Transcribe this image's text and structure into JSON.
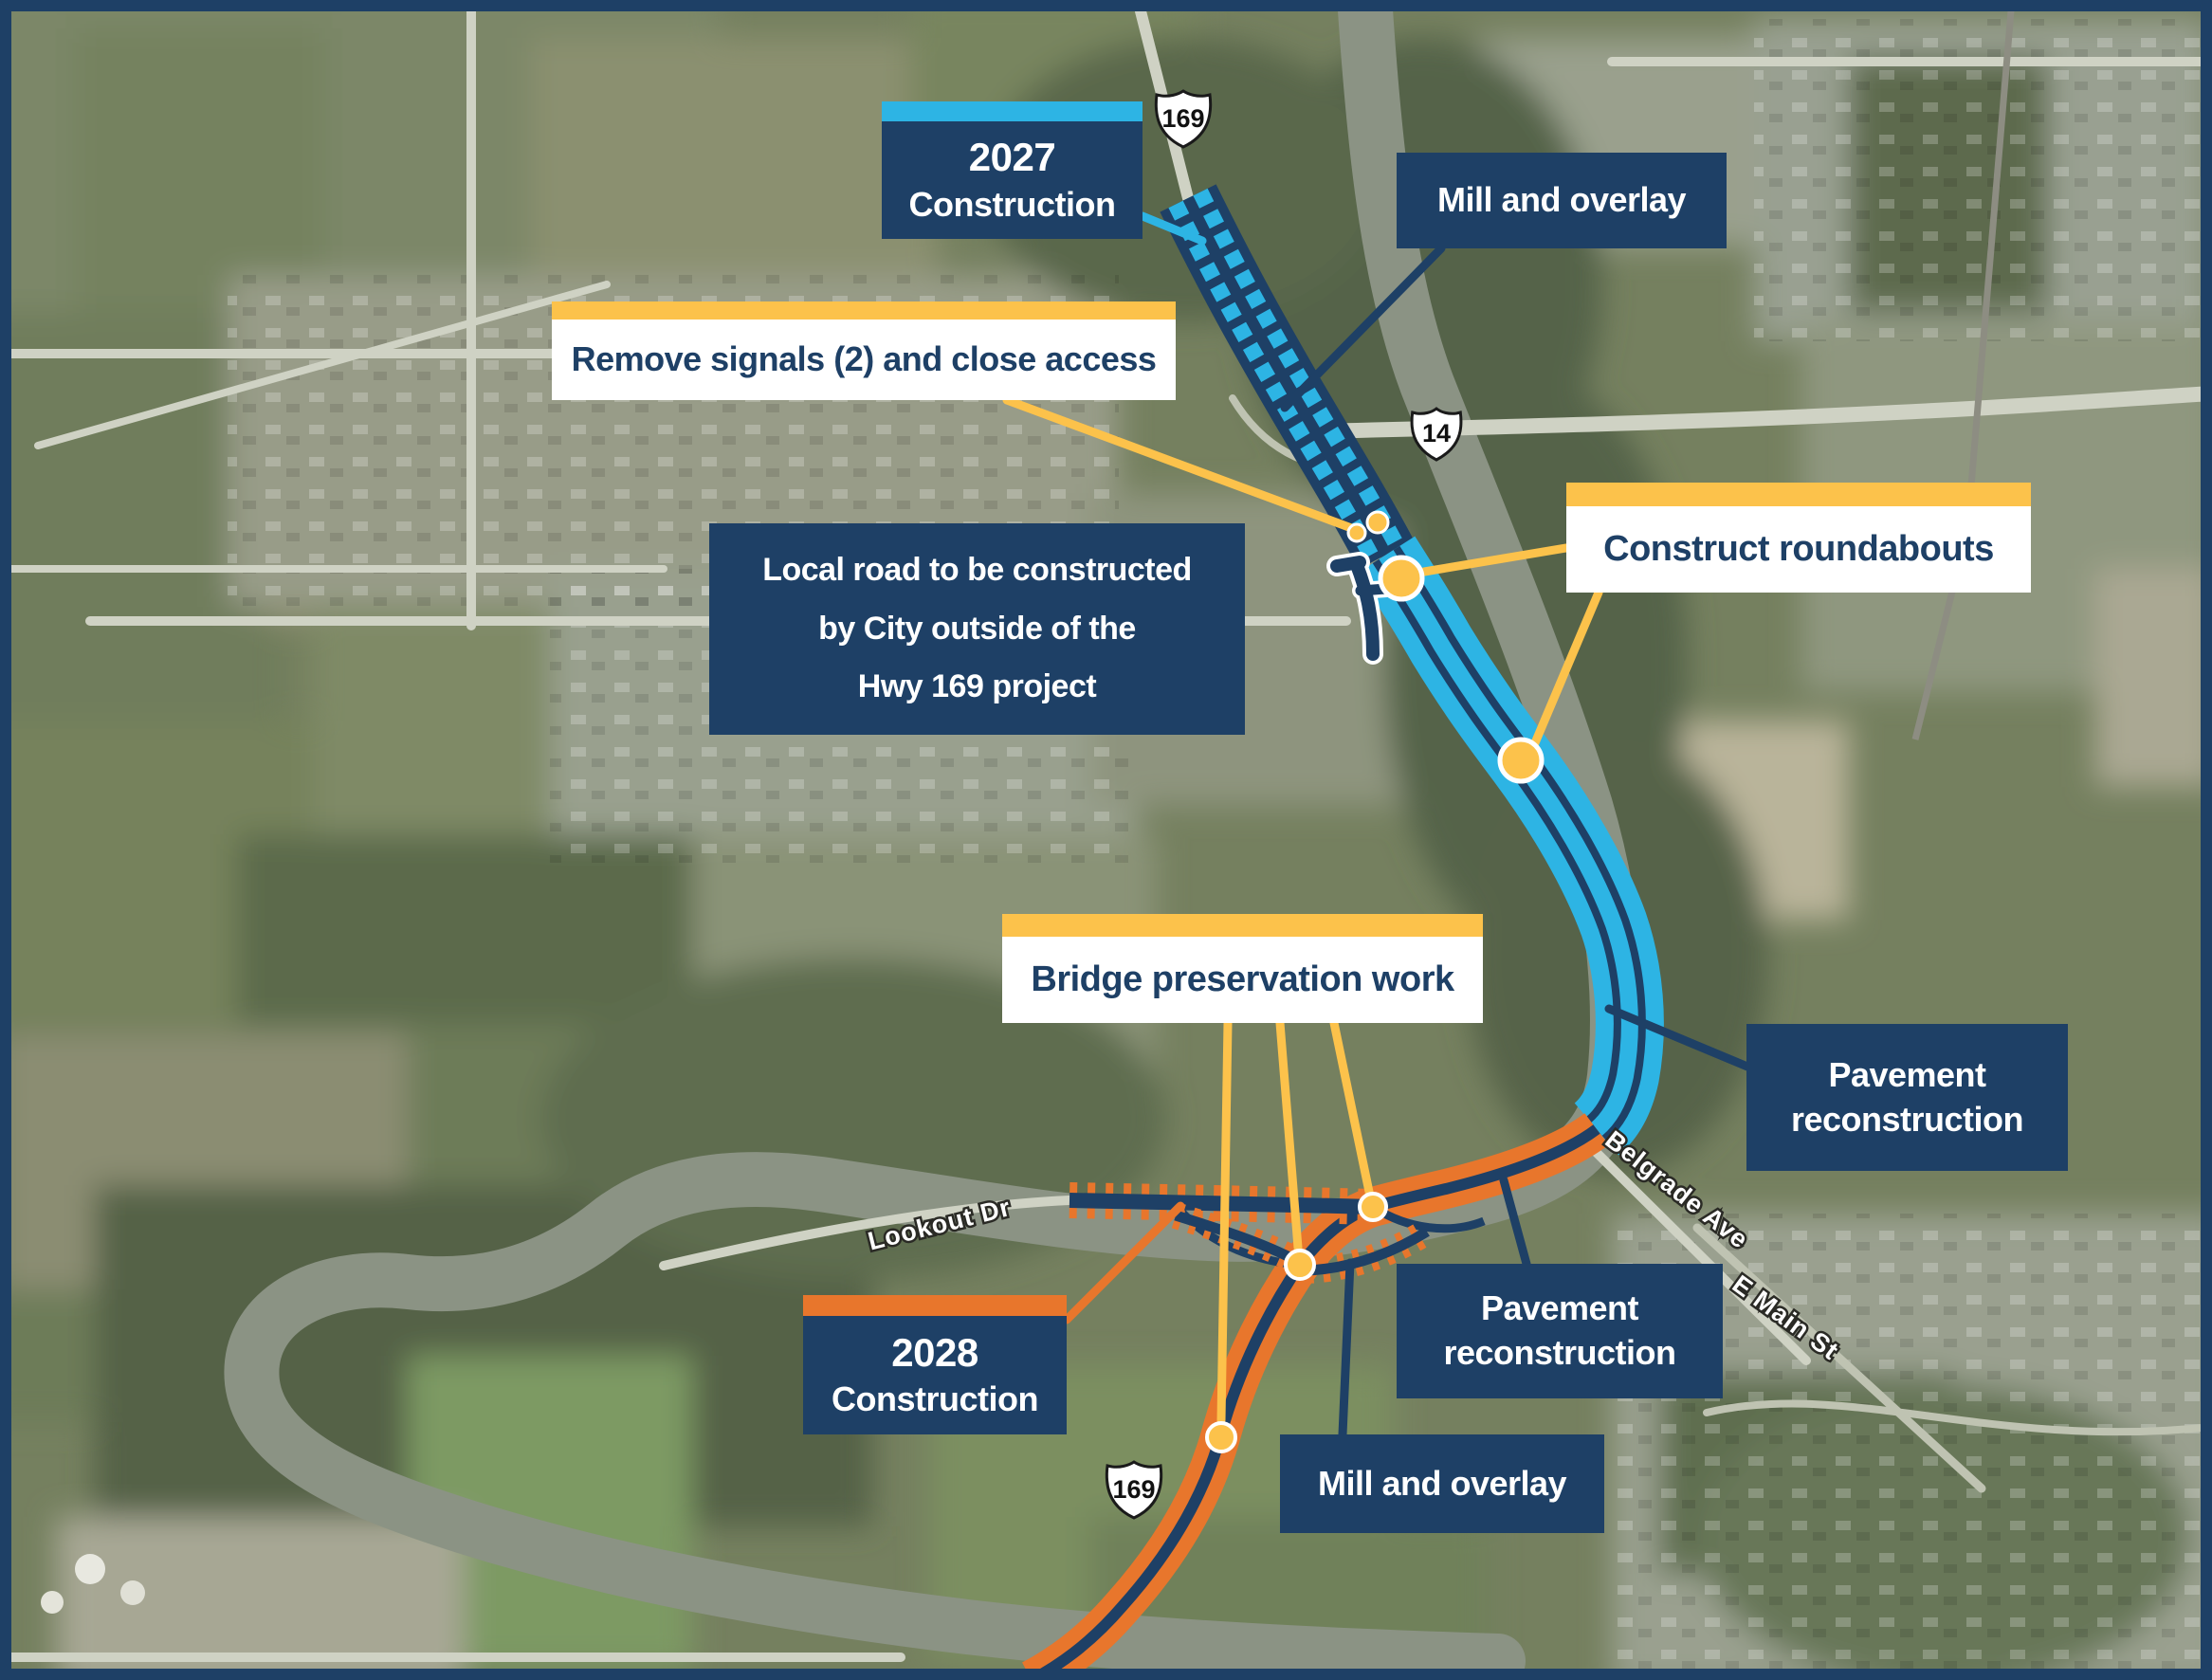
{
  "colors": {
    "navy": "#1e4066",
    "cyan": "#2db4e4",
    "yellow": "#fcc24b",
    "orange": "#e8762c"
  },
  "legend_labels": {
    "construction_2027": {
      "year": "2027",
      "word": "Construction"
    },
    "construction_2028": {
      "year": "2028",
      "word": "Construction"
    },
    "mill_overlay_top": "Mill and overlay",
    "mill_overlay_bottom": "Mill and overlay",
    "remove_signals": "Remove signals (2) and close access",
    "local_road": {
      "line1": "Local road to be constructed",
      "line2": "by City outside of the",
      "line3": "Hwy 169 project"
    },
    "construct_roundabouts": "Construct roundabouts",
    "bridge_preservation": "Bridge preservation work",
    "pavement_reconstruction_right": {
      "line1": "Pavement",
      "line2": "reconstruction"
    },
    "pavement_reconstruction_bottom": {
      "line1": "Pavement",
      "line2": "reconstruction"
    }
  },
  "highway_shields": {
    "top": "169",
    "middle": "14",
    "bottom": "169"
  },
  "street_labels": {
    "lookout": "Lookout Dr",
    "belgrade": "Belgrade Ave",
    "e_main": "E Main St"
  }
}
